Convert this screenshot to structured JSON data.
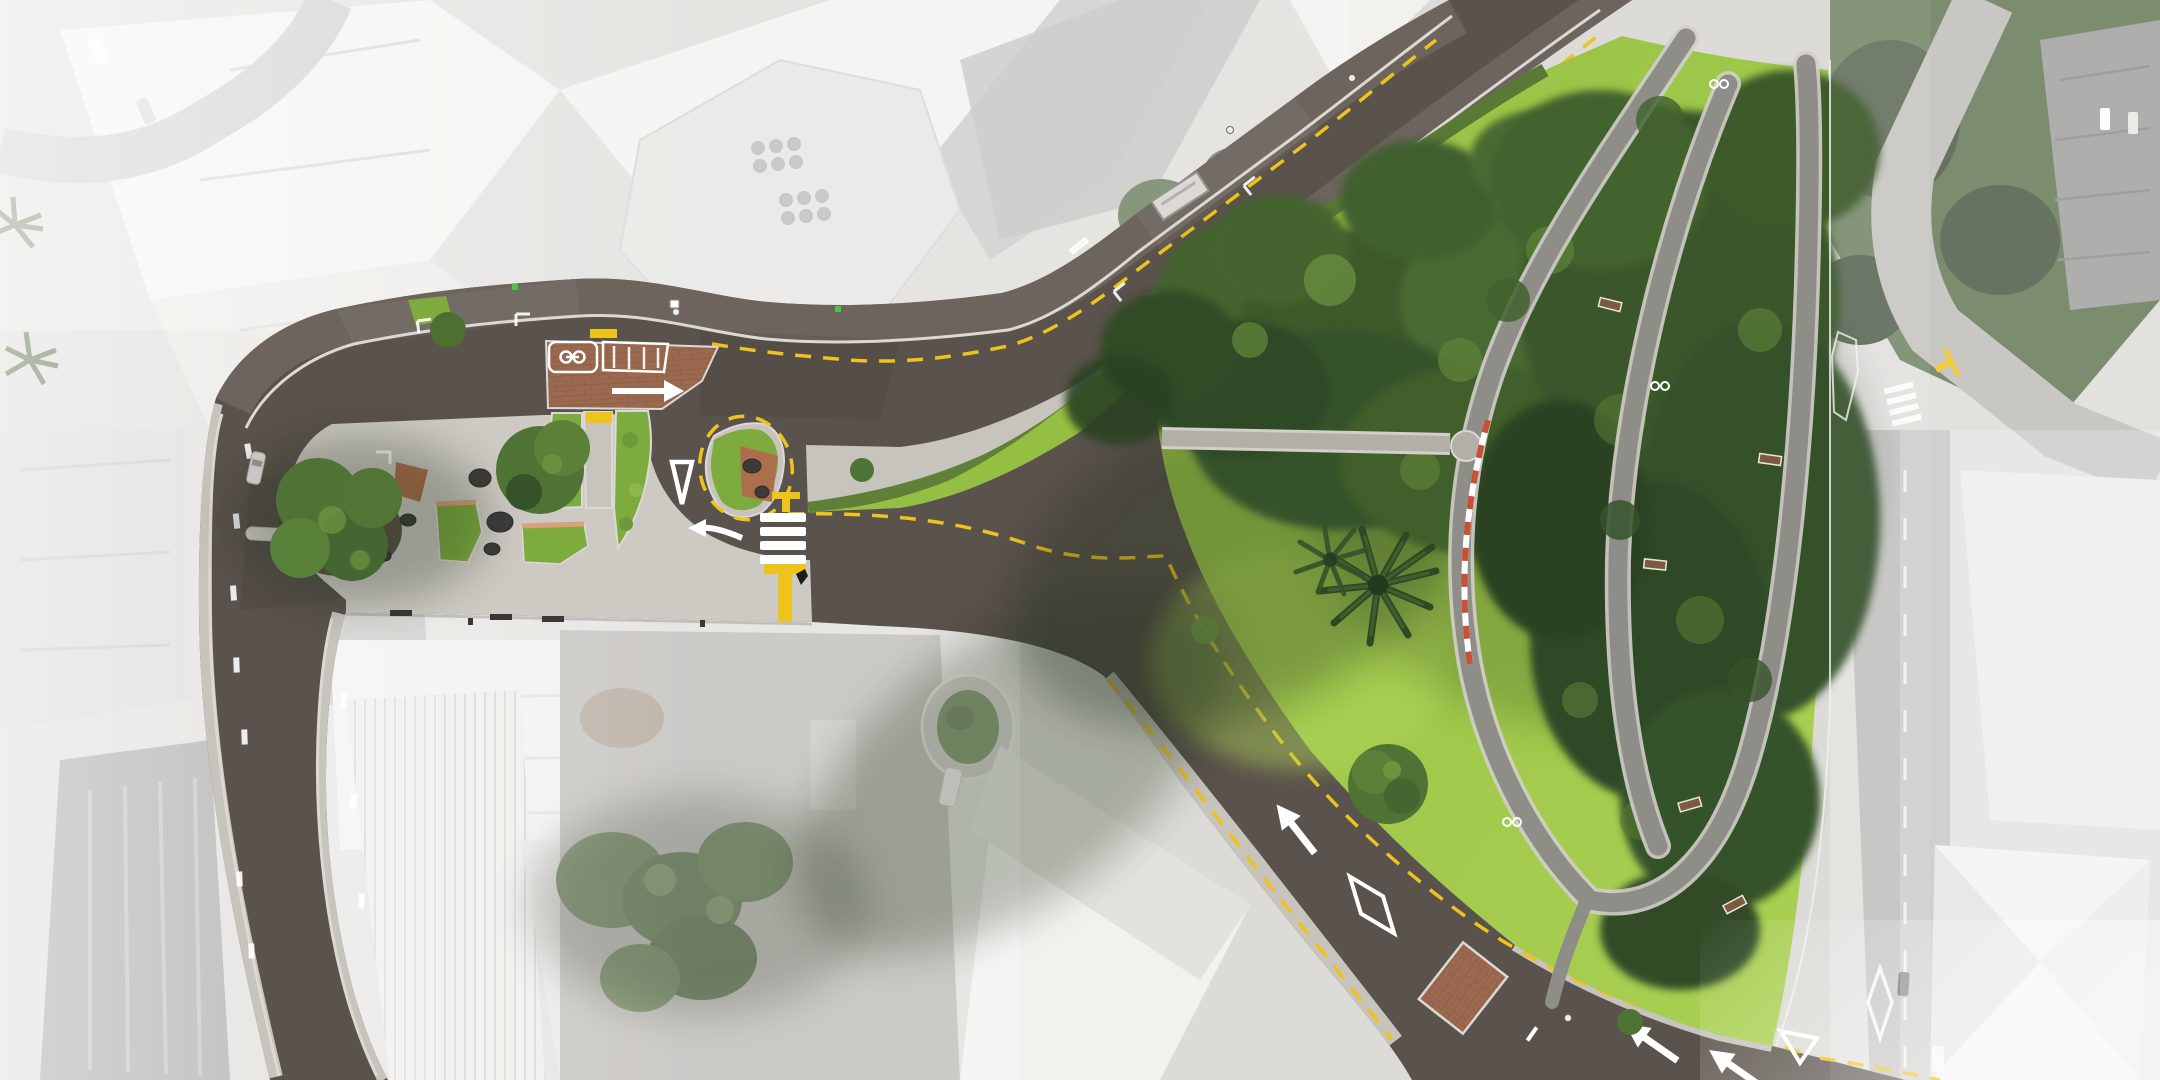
{
  "palette": {
    "road": "#5a524c",
    "footpath": "#6c645d",
    "sidewalk": "#c7c3bd",
    "plaza": "#cdc9c3",
    "parkPath": "#8f8d87",
    "parkPathLight": "#b2afa9",
    "curb": "#dcd9d4",
    "lawn1": "#95bf43",
    "lawn2": "#abd153",
    "hedge": "#5f8036",
    "shrub": "#7dab3e",
    "canopyDark": "#35522a",
    "canopyMid": "#44632e",
    "canopyLight": "#6c9340",
    "mulch": "#4e4237",
    "brick": "#9a6950",
    "brickLine": "#86573f",
    "copper": "#ad6f4b",
    "salmon": "#d9a07e",
    "markingYellow": "#eec31c",
    "markingWhite": "#ffffff",
    "redCurb": "#c94f35",
    "rock": "#3b3b39",
    "aerialBase": "#dcdbd7",
    "roofWhite": "#f2f1ee",
    "roofMid": "#d9d8d4",
    "roofDark": "#9d9e9a",
    "aerialRoad": "#b7b6b2",
    "aerialTree": "#5e7350",
    "aerialTreeDark": "#46543e",
    "signalGreen": "#47c83c",
    "shadow": "#24301c",
    "vanWhite": "#f4f3f0"
  },
  "features": {
    "crossings": {
      "zebra_stripes": 4,
      "raised_brick_crossings": 2
    },
    "markings": {
      "give_way_triangles": 2,
      "lane_arrows": 5,
      "marking_diamonds": 2,
      "yellow_no_stopping_lines": true,
      "yellow_T_marks": 4,
      "motorcycle_bay_symbols": 2,
      "bus_stop_yellow_box": 1
    },
    "park": {
      "benches": 5,
      "bike_racks": 3,
      "palm_trees": 2,
      "path_loops": 3,
      "lawn": true,
      "dense_tree_canopy": true
    },
    "plaza": {
      "planting_beds": 4,
      "boulders": 5,
      "street_trees": 6,
      "seats": 3
    },
    "transit": {
      "bus_shelters": 1
    },
    "vehicles": {
      "cars_visible": 6,
      "vans_visible": 1
    }
  }
}
